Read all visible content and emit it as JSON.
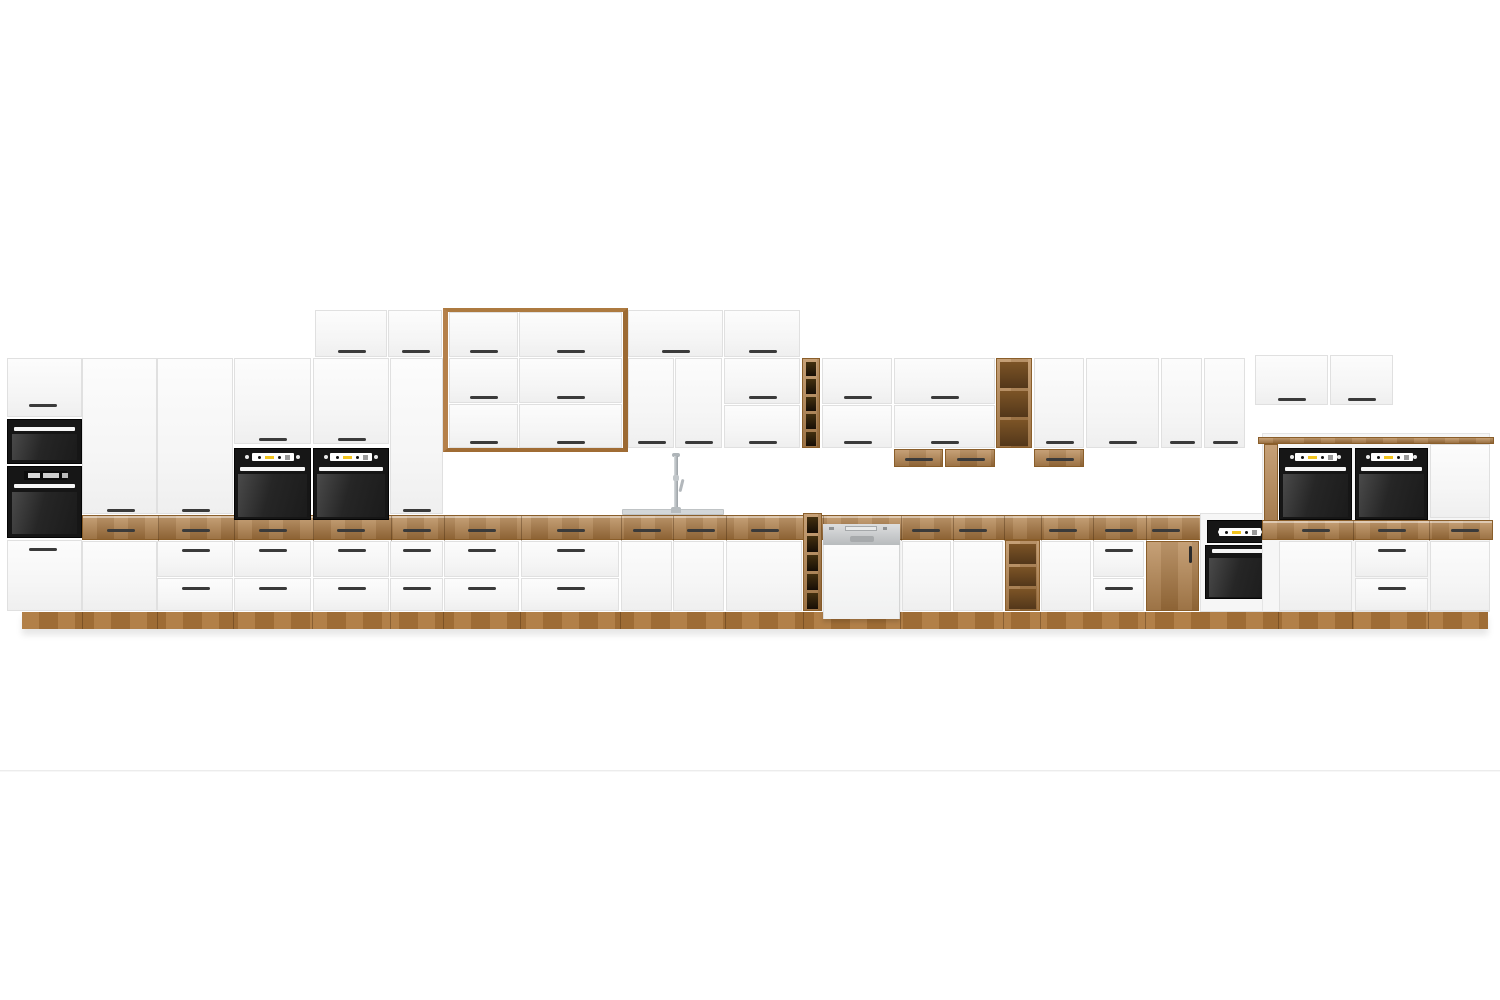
{
  "scene": {
    "description": "3D product render of a long modular kitchen cabinet wall on a white studio background",
    "width": 1500,
    "height": 1000,
    "background": "#ffffff",
    "floor_line_y": 770,
    "plinth": {
      "x": 22,
      "y": 612,
      "w": 1466,
      "h": 17,
      "seams": [
        82,
        157,
        233,
        312,
        390,
        443,
        520,
        620,
        725,
        803,
        900,
        1003,
        1040,
        1145,
        1278,
        1352,
        1428
      ]
    },
    "counter_left": {
      "x": 82,
      "y": 515,
      "w": 1180,
      "h": 25,
      "handle_y": 529,
      "handles": [
        120,
        195,
        272,
        350,
        416,
        481,
        570,
        646,
        700,
        764,
        925,
        972,
        1062,
        1118,
        1165
      ],
      "seams": [
        157,
        233,
        312,
        390,
        443,
        520,
        620,
        672,
        725,
        822,
        900,
        952,
        1003,
        1040,
        1092,
        1145,
        1200
      ]
    },
    "counter_right": {
      "x": 1262,
      "y": 520,
      "w": 231,
      "h": 20,
      "handle_y": 529,
      "handles": [
        1315,
        1391,
        1464
      ],
      "seams": [
        1352,
        1428
      ]
    }
  },
  "colors": {
    "front_white": "#f7f7f7",
    "front_edge": "#e0e0e0",
    "wood": "#b07c42",
    "wood_dark": "#8a5e2a",
    "wood_plinth": "#ab7539",
    "handle": "#3a3a3a",
    "appliance_black": "#161616",
    "oven_glass": "#262626",
    "display_white": "#ffffff",
    "accent_yellow": "#f2c41d",
    "display_gray": "#9a9a9a",
    "dishwasher_steel": "#c6c9cb",
    "sink_steel": "#d3d7d9",
    "faucet_chrome": "#aeb4b8",
    "floor_line": "#ececec"
  },
  "icons": [
    {
      "name": "oven-control-dots",
      "meaning": "white knob dots on black oven control panel"
    },
    {
      "name": "oven-display",
      "meaning": "white display window with black dots and yellow indicator"
    },
    {
      "name": "faucet",
      "meaning": "chrome single-lever kitchen tap"
    }
  ],
  "elements": [
    {
      "name": "floor-line",
      "type": "hline",
      "x": 0,
      "y": 770,
      "w": 1500,
      "h": 2
    },
    {
      "name": "plinth",
      "type": "plinth"
    },
    {
      "name": "counter-band-left",
      "type": "band",
      "key": "counter_left"
    },
    {
      "name": "tall-unit-door",
      "type": "door",
      "x": 7,
      "y": 358,
      "w": 75,
      "h": 59,
      "hx": 42,
      "hy": 404
    },
    {
      "name": "built-in-microwave",
      "type": "microwave",
      "x": 7,
      "y": 419,
      "w": 75,
      "h": 45
    },
    {
      "name": "built-in-oven-compact",
      "type": "ovenleft",
      "x": 7,
      "y": 466,
      "w": 75,
      "h": 72
    },
    {
      "name": "tall-unit-drawer",
      "type": "door",
      "x": 7,
      "y": 540,
      "w": 75,
      "h": 71,
      "hx": 42,
      "hy": 548
    },
    {
      "name": "tall-cabinet-door",
      "type": "door",
      "x": 82,
      "y": 358,
      "w": 75,
      "h": 156,
      "hx": 120,
      "hy": 509
    },
    {
      "name": "tall-cabinet-lower-door",
      "type": "door",
      "x": 82,
      "y": 541,
      "w": 75,
      "h": 70
    },
    {
      "name": "tall-cabinet-door",
      "type": "door",
      "x": 157,
      "y": 358,
      "w": 76,
      "h": 156,
      "hx": 195,
      "hy": 509
    },
    {
      "name": "base-drawer",
      "type": "door",
      "x": 157,
      "y": 541,
      "w": 76,
      "h": 36,
      "hx": 195,
      "hy": 549
    },
    {
      "name": "base-drawer",
      "type": "door",
      "x": 157,
      "y": 578,
      "w": 76,
      "h": 33,
      "hx": 195,
      "hy": 587
    },
    {
      "name": "oven-housing-door",
      "type": "door",
      "x": 234,
      "y": 358,
      "w": 77,
      "h": 86,
      "hx": 272,
      "hy": 438
    },
    {
      "name": "built-in-oven",
      "type": "oven",
      "x": 234,
      "y": 448,
      "w": 77,
      "h": 72
    },
    {
      "name": "base-drawer",
      "type": "door",
      "x": 234,
      "y": 541,
      "w": 77,
      "h": 36,
      "hx": 272,
      "hy": 549
    },
    {
      "name": "base-drawer",
      "type": "door",
      "x": 234,
      "y": 578,
      "w": 77,
      "h": 33,
      "hx": 272,
      "hy": 587
    },
    {
      "name": "oven-housing-door",
      "type": "door",
      "x": 313,
      "y": 358,
      "w": 76,
      "h": 86,
      "hx": 351,
      "hy": 438
    },
    {
      "name": "built-in-oven",
      "type": "oven",
      "x": 313,
      "y": 448,
      "w": 76,
      "h": 72
    },
    {
      "name": "base-drawer",
      "type": "door",
      "x": 313,
      "y": 541,
      "w": 76,
      "h": 36,
      "hx": 351,
      "hy": 549
    },
    {
      "name": "base-drawer",
      "type": "door",
      "x": 313,
      "y": 578,
      "w": 76,
      "h": 33,
      "hx": 351,
      "hy": 587
    },
    {
      "name": "top-cabinet-door",
      "type": "door",
      "x": 315,
      "y": 310,
      "w": 72,
      "h": 47,
      "hx": 351,
      "hy": 350
    },
    {
      "name": "top-cabinet-door",
      "type": "door",
      "x": 388,
      "y": 310,
      "w": 54,
      "h": 47,
      "hx": 415,
      "hy": 350
    },
    {
      "name": "tall-cabinet-door",
      "type": "door",
      "x": 390,
      "y": 358,
      "w": 53,
      "h": 156,
      "hx": 416,
      "hy": 509
    },
    {
      "name": "base-drawer",
      "type": "door",
      "x": 390,
      "y": 541,
      "w": 53,
      "h": 36,
      "hx": 416,
      "hy": 549
    },
    {
      "name": "base-drawer",
      "type": "door",
      "x": 390,
      "y": 578,
      "w": 53,
      "h": 33,
      "hx": 416,
      "hy": 587
    },
    {
      "name": "hood-wood-frame",
      "type": "frame",
      "x": 443,
      "y": 308,
      "w": 185,
      "h": 144
    },
    {
      "name": "top-cabinet-door",
      "type": "door",
      "x": 449,
      "y": 312,
      "w": 69,
      "h": 45,
      "hx": 483,
      "hy": 350
    },
    {
      "name": "top-cabinet-door",
      "type": "door",
      "x": 519,
      "y": 312,
      "w": 103,
      "h": 45,
      "hx": 570,
      "hy": 350
    },
    {
      "name": "wall-cabinet-door",
      "type": "door",
      "x": 449,
      "y": 358,
      "w": 69,
      "h": 45,
      "hx": 483,
      "hy": 396
    },
    {
      "name": "wall-cabinet-door",
      "type": "door",
      "x": 449,
      "y": 404,
      "w": 69,
      "h": 44,
      "hx": 483,
      "hy": 441
    },
    {
      "name": "wall-cabinet-door",
      "type": "door",
      "x": 519,
      "y": 358,
      "w": 103,
      "h": 45,
      "hx": 570,
      "hy": 396
    },
    {
      "name": "wall-cabinet-door",
      "type": "door",
      "x": 519,
      "y": 404,
      "w": 103,
      "h": 44,
      "hx": 570,
      "hy": 441
    },
    {
      "name": "top-cabinet-door",
      "type": "door",
      "x": 628,
      "y": 310,
      "w": 95,
      "h": 47,
      "hx": 675,
      "hy": 350
    },
    {
      "name": "top-cabinet-door",
      "type": "door",
      "x": 724,
      "y": 310,
      "w": 76,
      "h": 47,
      "hx": 762,
      "hy": 350
    },
    {
      "name": "wall-cabinet-door",
      "type": "door",
      "x": 628,
      "y": 358,
      "w": 46,
      "h": 90,
      "hx": 651,
      "hy": 441
    },
    {
      "name": "wall-cabinet-door",
      "type": "door",
      "x": 675,
      "y": 358,
      "w": 47,
      "h": 90,
      "hx": 698,
      "hy": 441
    },
    {
      "name": "wall-cabinet-door",
      "type": "door",
      "x": 724,
      "y": 358,
      "w": 76,
      "h": 46,
      "hx": 762,
      "hy": 396
    },
    {
      "name": "wall-cabinet-door",
      "type": "door",
      "x": 724,
      "y": 405,
      "w": 76,
      "h": 43,
      "hx": 762,
      "hy": 441
    },
    {
      "name": "wall-wine-rack",
      "type": "rack",
      "x": 802,
      "y": 358,
      "w": 18,
      "h": 90,
      "cells": 5,
      "dark": true
    },
    {
      "name": "wall-cabinet-door",
      "type": "door",
      "x": 822,
      "y": 358,
      "w": 70,
      "h": 46,
      "hx": 857,
      "hy": 396
    },
    {
      "name": "wall-cabinet-door",
      "type": "door",
      "x": 822,
      "y": 405,
      "w": 70,
      "h": 43,
      "hx": 857,
      "hy": 441
    },
    {
      "name": "wall-cabinet-door",
      "type": "door",
      "x": 894,
      "y": 358,
      "w": 101,
      "h": 46,
      "hx": 944,
      "hy": 396
    },
    {
      "name": "wall-cabinet-door",
      "type": "door",
      "x": 894,
      "y": 405,
      "w": 101,
      "h": 43,
      "hx": 944,
      "hy": 441
    },
    {
      "name": "wall-hanging-drawer",
      "type": "woodfront",
      "x": 894,
      "y": 449,
      "w": 49,
      "h": 18,
      "hx": 918,
      "hy": 458
    },
    {
      "name": "wall-hanging-drawer",
      "type": "woodfront",
      "x": 945,
      "y": 449,
      "w": 50,
      "h": 18,
      "hx": 970,
      "hy": 458
    },
    {
      "name": "wall-open-shelf",
      "type": "rack",
      "x": 996,
      "y": 358,
      "w": 36,
      "h": 90,
      "cells": 3,
      "dark": false
    },
    {
      "name": "wall-cabinet-door",
      "type": "door",
      "x": 1034,
      "y": 358,
      "w": 50,
      "h": 90,
      "hx": 1059,
      "hy": 441
    },
    {
      "name": "wall-hanging-drawer",
      "type": "woodfront",
      "x": 1034,
      "y": 449,
      "w": 50,
      "h": 18,
      "hx": 1059,
      "hy": 458
    },
    {
      "name": "wall-cabinet-door",
      "type": "door",
      "x": 1086,
      "y": 358,
      "w": 73,
      "h": 90,
      "hx": 1122,
      "hy": 441
    },
    {
      "name": "wall-cabinet-door",
      "type": "door",
      "x": 1161,
      "y": 358,
      "w": 41,
      "h": 90,
      "hx": 1181,
      "hy": 441
    },
    {
      "name": "wall-cabinet-door",
      "type": "door",
      "x": 1204,
      "y": 358,
      "w": 41,
      "h": 90,
      "hx": 1224,
      "hy": 441
    },
    {
      "name": "wall-cabinet-door",
      "type": "door",
      "x": 1255,
      "y": 355,
      "w": 73,
      "h": 50,
      "hx": 1291,
      "hy": 398
    },
    {
      "name": "wall-cabinet-door",
      "type": "door",
      "x": 1330,
      "y": 355,
      "w": 63,
      "h": 50,
      "hx": 1361,
      "hy": 398
    },
    {
      "name": "base-drawer",
      "type": "door",
      "x": 444,
      "y": 541,
      "w": 75,
      "h": 36,
      "hx": 481,
      "hy": 549
    },
    {
      "name": "base-drawer",
      "type": "door",
      "x": 444,
      "y": 578,
      "w": 75,
      "h": 33,
      "hx": 481,
      "hy": 587
    },
    {
      "name": "base-drawer",
      "type": "door",
      "x": 521,
      "y": 541,
      "w": 98,
      "h": 36,
      "hx": 570,
      "hy": 549
    },
    {
      "name": "base-drawer",
      "type": "door",
      "x": 521,
      "y": 578,
      "w": 98,
      "h": 33,
      "hx": 570,
      "hy": 587
    },
    {
      "name": "sink-cabinet-door",
      "type": "door",
      "x": 621,
      "y": 541,
      "w": 51,
      "h": 70
    },
    {
      "name": "sink-cabinet-door",
      "type": "door",
      "x": 673,
      "y": 541,
      "w": 51,
      "h": 70
    },
    {
      "name": "base-cabinet-door",
      "type": "door",
      "x": 726,
      "y": 541,
      "w": 76,
      "h": 70
    },
    {
      "name": "base-wine-rack",
      "type": "rack",
      "x": 803,
      "y": 513,
      "w": 19,
      "h": 98,
      "cells": 5,
      "dark": true
    },
    {
      "name": "dishwasher",
      "type": "dishwasher",
      "x": 823,
      "y": 524,
      "w": 77,
      "h": 95
    },
    {
      "name": "base-cabinet-door",
      "type": "door",
      "x": 902,
      "y": 541,
      "w": 49,
      "h": 70
    },
    {
      "name": "base-cabinet-door",
      "type": "door",
      "x": 953,
      "y": 541,
      "w": 50,
      "h": 70
    },
    {
      "name": "base-open-shelf",
      "type": "rack",
      "x": 1005,
      "y": 540,
      "w": 35,
      "h": 71,
      "cells": 3,
      "dark": false
    },
    {
      "name": "base-cabinet-door",
      "type": "door",
      "x": 1041,
      "y": 541,
      "w": 50,
      "h": 70
    },
    {
      "name": "base-drawer",
      "type": "door",
      "x": 1093,
      "y": 541,
      "w": 51,
      "h": 36,
      "hx": 1118,
      "hy": 549
    },
    {
      "name": "base-drawer",
      "type": "door",
      "x": 1093,
      "y": 578,
      "w": 51,
      "h": 33,
      "hx": 1118,
      "hy": 587
    },
    {
      "name": "wood-cabinet-door",
      "type": "wooddoor",
      "x": 1146,
      "y": 541,
      "w": 53,
      "h": 70
    },
    {
      "name": "under-counter-oven",
      "type": "ovenunder",
      "x": 1200,
      "y": 513,
      "w": 78,
      "h": 99
    },
    {
      "name": "sideboard-body",
      "type": "body",
      "x": 1262,
      "y": 433,
      "w": 228,
      "h": 179
    },
    {
      "name": "sideboard-side-panel",
      "type": "woodpanel",
      "x": 1264,
      "y": 444,
      "w": 14,
      "h": 96
    },
    {
      "name": "built-in-oven",
      "type": "oven",
      "x": 1279,
      "y": 448,
      "w": 73,
      "h": 72
    },
    {
      "name": "built-in-oven",
      "type": "oven",
      "x": 1355,
      "y": 448,
      "w": 73,
      "h": 72
    },
    {
      "name": "sideboard-door",
      "type": "door",
      "x": 1430,
      "y": 444,
      "w": 60,
      "h": 74
    },
    {
      "name": "counter-band-right",
      "type": "band",
      "key": "counter_right"
    },
    {
      "name": "sideboard-counter-top",
      "type": "woodpanel",
      "x": 1258,
      "y": 437,
      "w": 236,
      "h": 7
    },
    {
      "name": "sideboard-door",
      "type": "door",
      "x": 1279,
      "y": 541,
      "w": 73,
      "h": 70
    },
    {
      "name": "base-drawer",
      "type": "door",
      "x": 1355,
      "y": 541,
      "w": 73,
      "h": 36,
      "hx": 1391,
      "hy": 549
    },
    {
      "name": "base-drawer",
      "type": "door",
      "x": 1355,
      "y": 578,
      "w": 73,
      "h": 33,
      "hx": 1391,
      "hy": 587
    },
    {
      "name": "sideboard-door",
      "type": "door",
      "x": 1430,
      "y": 541,
      "w": 60,
      "h": 70
    },
    {
      "name": "sink",
      "type": "sink",
      "x": 622,
      "y": 509,
      "w": 102,
      "h": 6
    },
    {
      "name": "faucet",
      "type": "faucet",
      "x": 666,
      "y": 453,
      "w": 22,
      "h": 60
    }
  ]
}
